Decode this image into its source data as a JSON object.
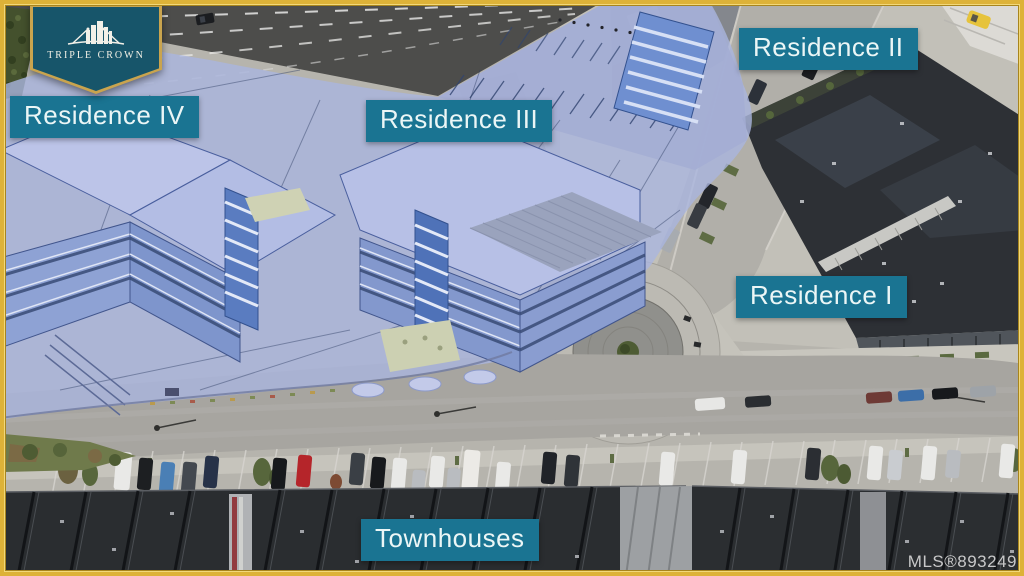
{
  "branding": {
    "name": "TRIPLE CROWN",
    "icon": "city-crown-icon"
  },
  "labels": {
    "residence_iv": "Residence IV",
    "residence_iii": "Residence III",
    "residence_ii": "Residence II",
    "residence_i": "Residence I",
    "townhouses": "Townhouses"
  },
  "watermark": {
    "text": "MLS®893249"
  },
  "colors": {
    "frame_gold": "#ddb238",
    "label_background": "#1a7492",
    "label_text": "#ebf6f6",
    "badge_background": "#17556a",
    "badge_gold": "#c9a44e",
    "render_overlay": "#aab5de",
    "render_accent": "#4f72b8",
    "roof_dark": "#2b2e31",
    "road_gray": "#a7a5a0",
    "landscape_green": "#57663e"
  }
}
